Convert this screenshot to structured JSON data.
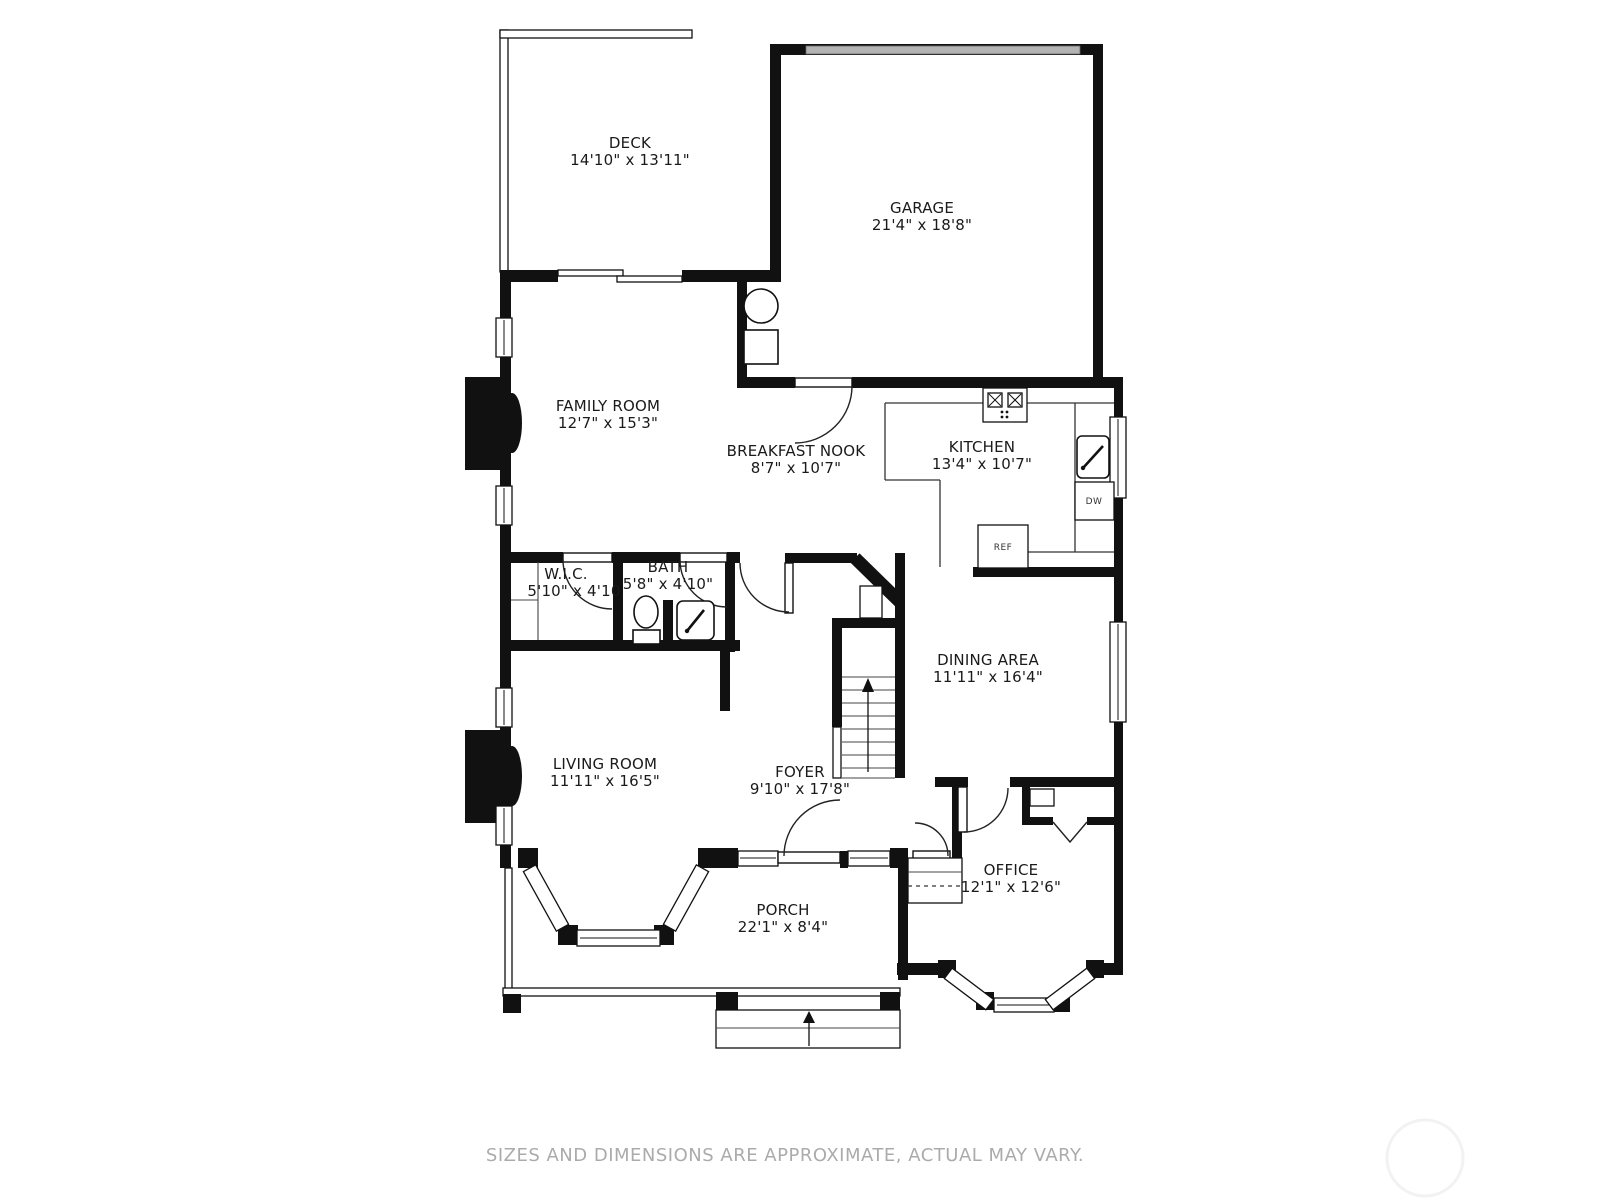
{
  "page": {
    "disclaimer": "SIZES AND DIMENSIONS ARE APPROXIMATE, ACTUAL MAY VARY."
  },
  "rooms": [
    {
      "id": "deck",
      "name": "DECK",
      "dims": "14'10\" x 13'11\""
    },
    {
      "id": "garage",
      "name": "GARAGE",
      "dims": "21'4\" x 18'8\""
    },
    {
      "id": "family-room",
      "name": "FAMILY ROOM",
      "dims": "12'7\" x 15'3\""
    },
    {
      "id": "breakfast-nook",
      "name": "BREAKFAST NOOK",
      "dims": "8'7\" x 10'7\""
    },
    {
      "id": "kitchen",
      "name": "KITCHEN",
      "dims": "13'4\" x 10'7\""
    },
    {
      "id": "wic",
      "name": "W.I.C.",
      "dims": "5'10\" x 4'10"
    },
    {
      "id": "bath",
      "name": "BATH",
      "dims": "5'8\" x 4'10\""
    },
    {
      "id": "dining-area",
      "name": "DINING AREA",
      "dims": "11'11\" x 16'4\""
    },
    {
      "id": "living-room",
      "name": "LIVING ROOM",
      "dims": "11'11\" x 16'5\""
    },
    {
      "id": "foyer",
      "name": "FOYER",
      "dims": "9'10\" x 17'8\""
    },
    {
      "id": "office",
      "name": "OFFICE",
      "dims": "12'1\" x 12'6\""
    },
    {
      "id": "porch",
      "name": "PORCH",
      "dims": "22'1\" x 8'4\""
    }
  ],
  "appliances": {
    "dishwasher": "DW",
    "refrigerator": "REF"
  },
  "colors": {
    "wall": "#111111",
    "garage_door": "#b3b3b3",
    "label": "#1a1a1a",
    "disclaimer": "#ababab"
  }
}
